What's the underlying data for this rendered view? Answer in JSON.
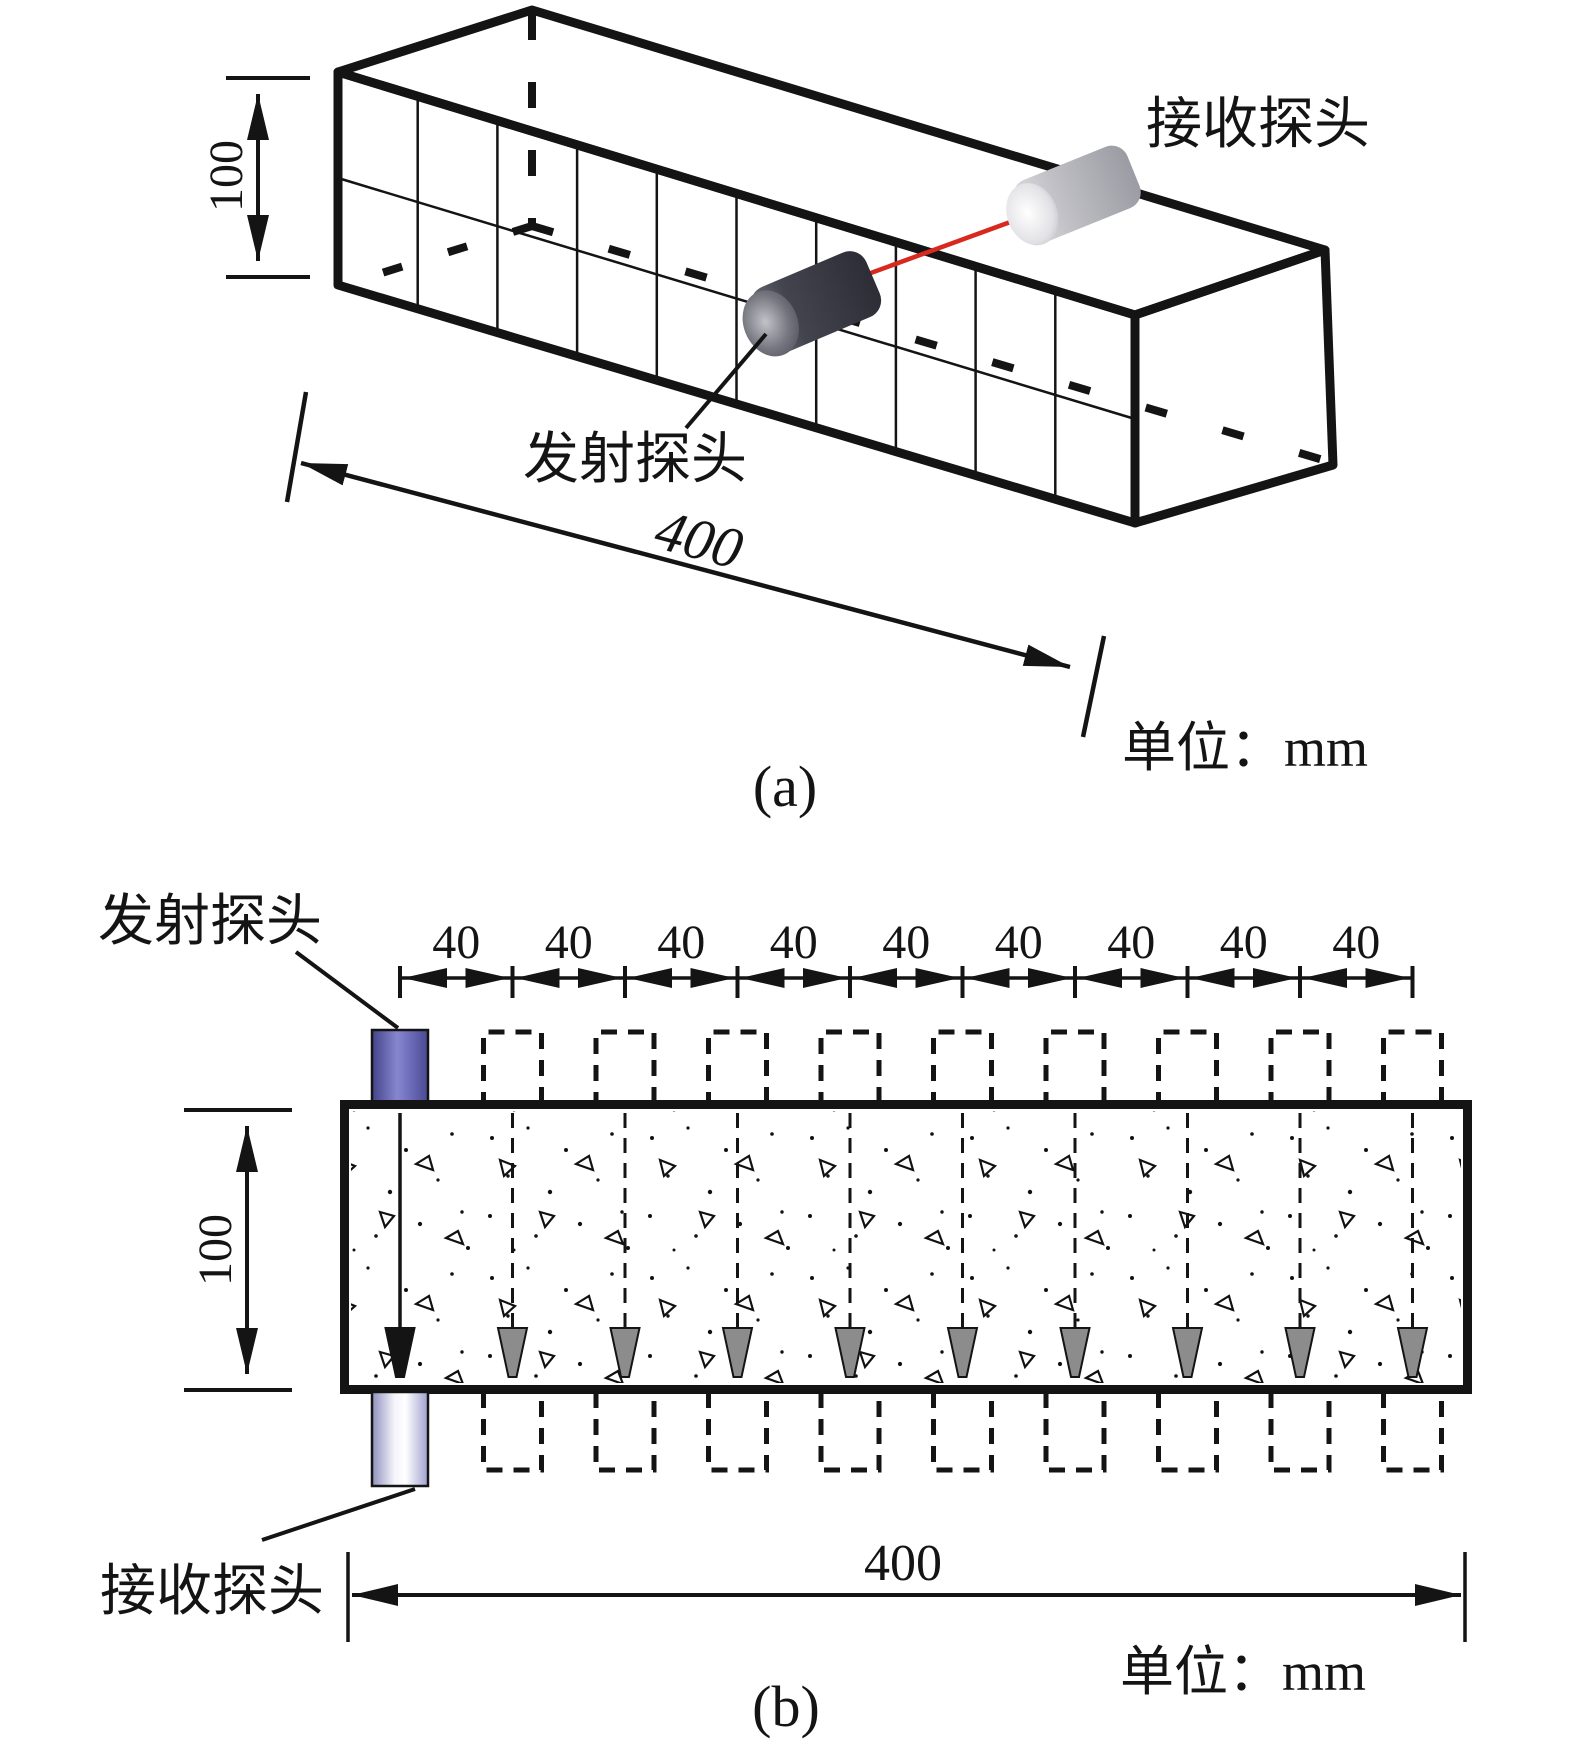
{
  "figure": {
    "unit_label": "单位：mm",
    "part_a": {
      "caption": "(a)",
      "receiver_label": "接收探头",
      "transmitter_label": "发射探头",
      "height_dim": "100",
      "length_dim": "400"
    },
    "part_b": {
      "caption": "(b)",
      "transmitter_label": "发射探头",
      "receiver_label": "接收探头",
      "height_dim": "100",
      "length_dim": "400",
      "num_positions": 10,
      "spacing_labels": [
        "40",
        "40",
        "40",
        "40",
        "40",
        "40",
        "40",
        "40",
        "40"
      ]
    },
    "colors": {
      "line_black": "#141414",
      "signal_red": "#d8291f",
      "probe_purple_dark": "#4a4a91",
      "probe_purple_light": "#8787d0",
      "probe_bottom_light": "#f4f4fa",
      "arrow_gray": "#8c8c8c"
    }
  }
}
